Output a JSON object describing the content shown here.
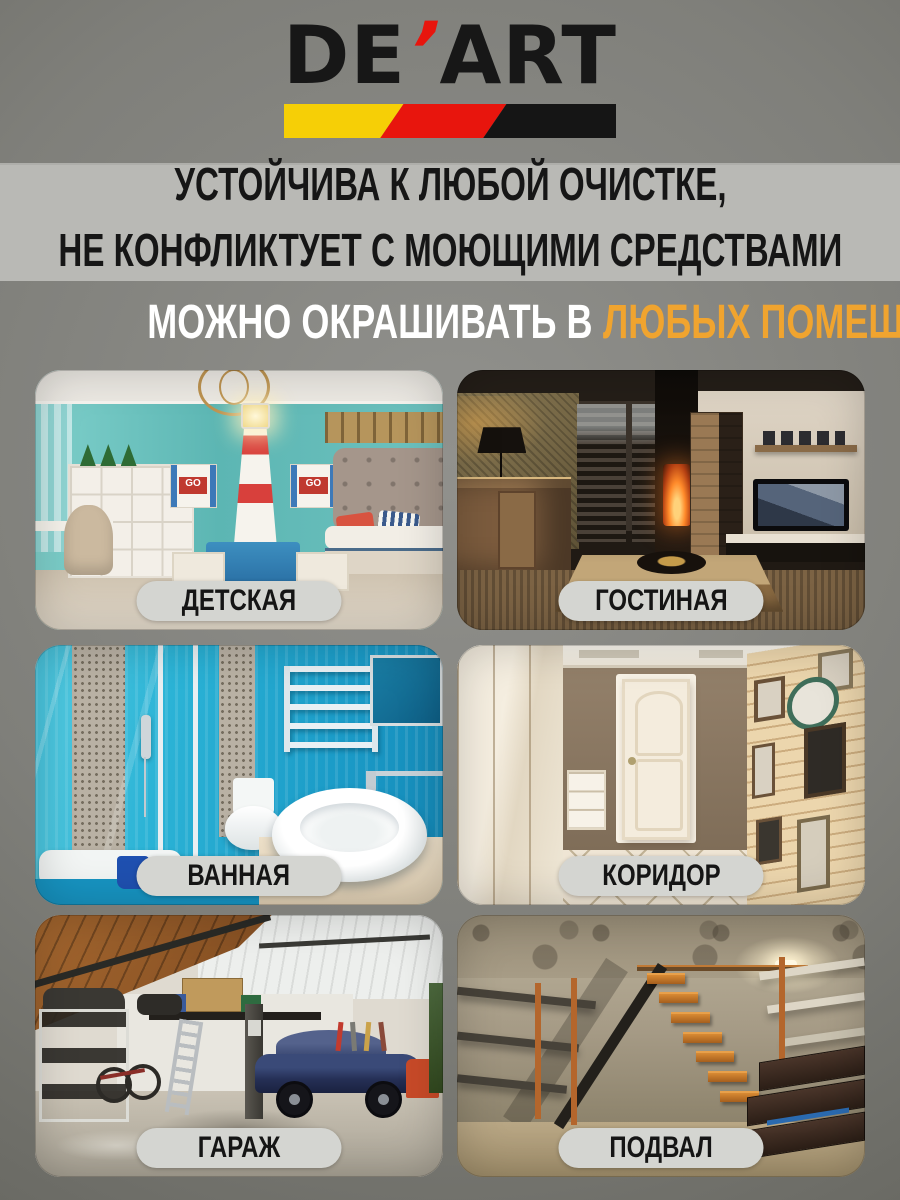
{
  "colors": {
    "accent_orange": "#f0a42f",
    "stripe_yellow": "#f6cf06",
    "stripe_red": "#e8150d",
    "stripe_black": "#151515",
    "band_bg": "#b9b9b5",
    "badge_bg": "#d4d5d1"
  },
  "brand": {
    "logo_left": "DE",
    "logo_apostrophe": "’",
    "logo_right": "ART"
  },
  "headline": {
    "line1": "УСТОЙЧИВА К ЛЮБОЙ ОЧИСТКЕ,",
    "line2": "НЕ КОНФЛИКТУЕТ С МОЮЩИМИ СРЕДСТВАМИ"
  },
  "subheadline": {
    "white": "МОЖНО ОКРАШИВАТЬ В",
    "orange": "ЛЮБЫХ ПОМЕЩЕНИЯХ"
  },
  "photo_labels": {
    "go_box": "GO"
  },
  "rooms": [
    {
      "label": "ДЕТСКАЯ"
    },
    {
      "label": "ГОСТИНАЯ"
    },
    {
      "label": "ВАННАЯ"
    },
    {
      "label": "КОРИДОР"
    },
    {
      "label": "ГАРАЖ"
    },
    {
      "label": "ПОДВАЛ"
    }
  ]
}
